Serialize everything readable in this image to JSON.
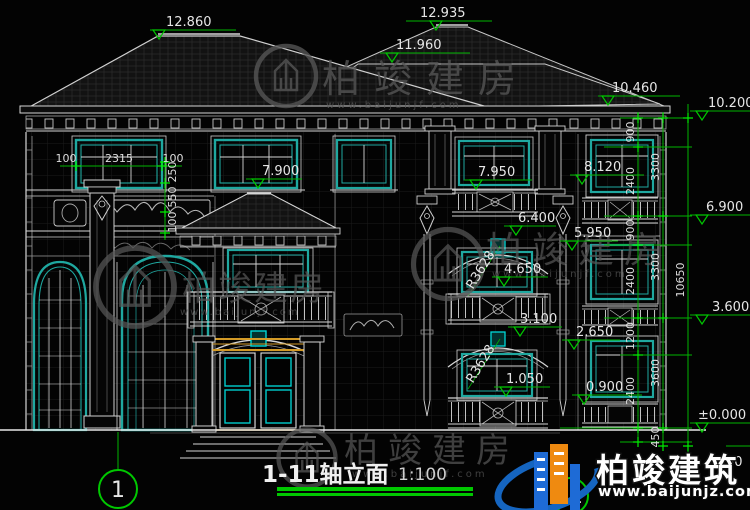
{
  "drawing": {
    "title": "1-11轴立面",
    "scale": "1:100",
    "axis_left": "1",
    "axis_right": "11",
    "levels": {
      "roof_ridge_left": "12.860",
      "roof_ridge_back": "12.935",
      "roof_mid": "11.960",
      "eave_right": "10.460",
      "parapet": "10.200",
      "balcony_f3": "8.120",
      "window_f3": "7.950",
      "porch_roof": "7.900",
      "floor_3": "6.900",
      "arch_f2": "6.400",
      "balcony_f2": "5.950",
      "window_f2": "4.650",
      "floor_2": "3.600",
      "arch_f1": "3.100",
      "balcony_f1": "2.650",
      "window_f1": "1.050",
      "plinth": "0.900",
      "ground": "±0.000",
      "fragment": "50"
    },
    "dims": {
      "margin_left": "100",
      "window_width": "2315",
      "margin_right": "100",
      "left_chain": [
        "250",
        "550",
        "100"
      ],
      "right_inner": [
        "900",
        "2400",
        "900",
        "2400",
        "1200",
        "2400"
      ],
      "right_mid": [
        "3300",
        "3300",
        "3600",
        "450"
      ],
      "total_height": "10650"
    },
    "radius": {
      "arc_f2": "R3628",
      "arc_f1": "R3628"
    }
  },
  "watermark": {
    "brand": "柏竣建房",
    "url": "www.baijunjf.com"
  },
  "logo": {
    "brand": "柏竣建筑",
    "url": "www.baijunjz.com"
  },
  "colors": {
    "dimension_green": "#00c800",
    "window_teal": "#1fa8a0",
    "door_gold": "#d39a26",
    "door_teal": "#00cccc",
    "logo_blue": "#1565c0",
    "logo_orange": "#ef8a10"
  }
}
